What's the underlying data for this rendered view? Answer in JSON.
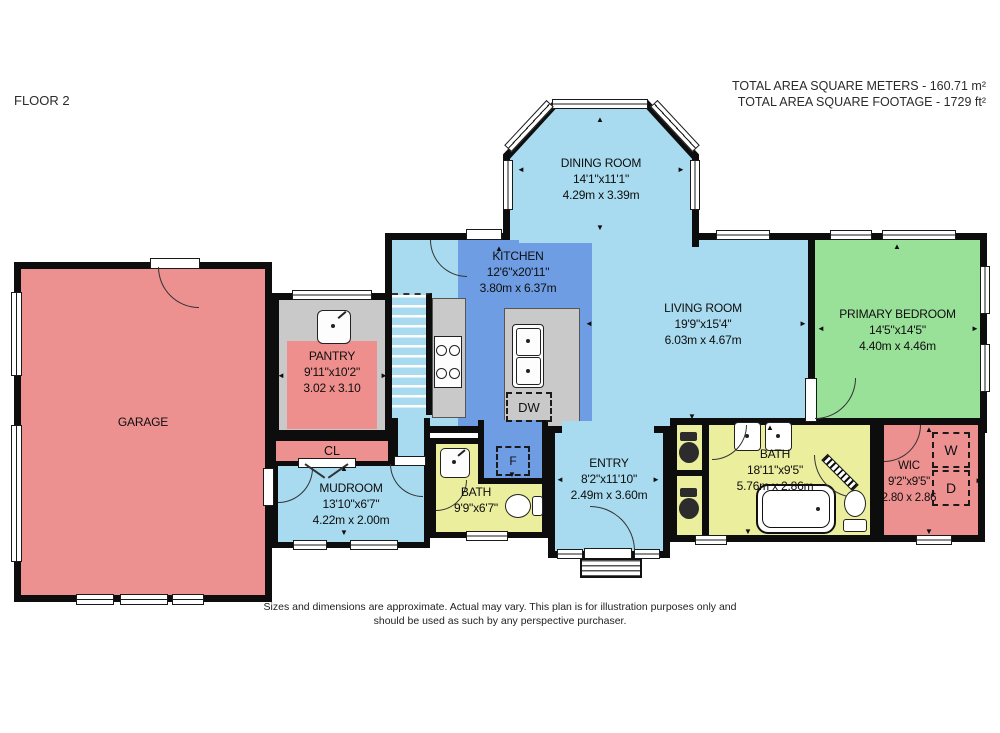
{
  "header": {
    "floor_label": "FLOOR 2",
    "area_metric": "TOTAL AREA SQUARE METERS - 160.71 m²",
    "area_imperial": "TOTAL AREA SQUARE FOOTAGE - 1729 ft²"
  },
  "footer": {
    "disclaimer_line1": "Sizes and dimensions are approximate. Actual may vary. This plan is for illustration purposes only and",
    "disclaimer_line2": "should be used as such by any perspective purchaser."
  },
  "rooms": {
    "garage": {
      "name": "GARAGE"
    },
    "pantry": {
      "name": "PANTRY",
      "dim_ft": "9'11\"x10'2\"",
      "dim_m": "3.02 x 3.10"
    },
    "closet": {
      "name": "CL"
    },
    "mudroom": {
      "name": "MUDROOM",
      "dim_ft": "13'10\"x6'7\"",
      "dim_m": "4.22m x 2.00m"
    },
    "bath_small": {
      "name": "BATH",
      "dim_ft": "9'9\"x6'7\""
    },
    "kitchen": {
      "name": "KITCHEN",
      "dim_ft": "12'6\"x20'11\"",
      "dim_m": "3.80m x 6.37m"
    },
    "dining": {
      "name": "DINING ROOM",
      "dim_ft": "14'1\"x11'1\"",
      "dim_m": "4.29m x 3.39m"
    },
    "living": {
      "name": "LIVING ROOM",
      "dim_ft": "19'9\"x15'4\"",
      "dim_m": "6.03m x 4.67m"
    },
    "primary": {
      "name": "PRIMARY BEDROOM",
      "dim_ft": "14'5\"x14'5\"",
      "dim_m": "4.40m x 4.46m"
    },
    "entry": {
      "name": "ENTRY",
      "dim_ft": "8'2\"x11'10\"",
      "dim_m": "2.49m x 3.60m"
    },
    "bath_main": {
      "name": "BATH",
      "dim_ft": "18'11\"x9'5\"",
      "dim_m": "5.76m x 2.86m"
    },
    "wic": {
      "name": "WIC",
      "dim_ft": "9'2\"x9'5\"",
      "dim_m": "2.80 x 2.86"
    }
  },
  "appliances": {
    "dishwasher": "DW",
    "fridge": "F",
    "washer": "W",
    "dryer": "D"
  },
  "glyphs": {
    "up": "▲",
    "down": "▼",
    "left": "◄",
    "right": "►"
  },
  "colors": {
    "room_blue": "#A8DBEF",
    "kitchen_blue": "#6E9DE4",
    "bedroom_green": "#99E099",
    "salmon": "#EC9190",
    "bath_yellow": "#EBEE9D",
    "floor_gray": "#C9C9C9",
    "wall": "#0D0D0D"
  }
}
